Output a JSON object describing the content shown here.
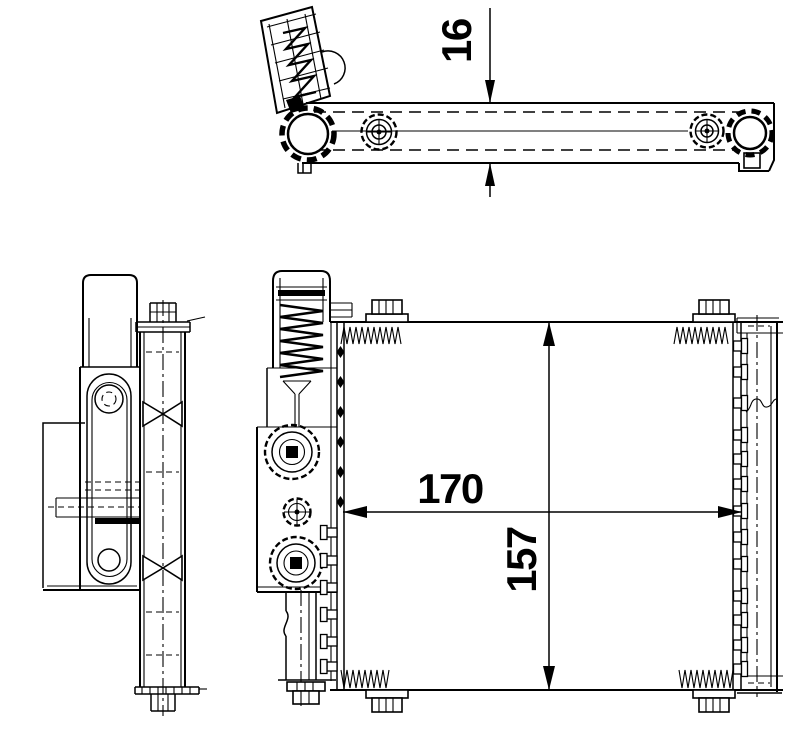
{
  "drawing": {
    "background_color": "#ffffff",
    "line_color": "#000000"
  },
  "dimensions": {
    "profile_thickness": {
      "label": "16"
    },
    "core_width": {
      "label": "170"
    },
    "core_height": {
      "label": "157"
    }
  }
}
